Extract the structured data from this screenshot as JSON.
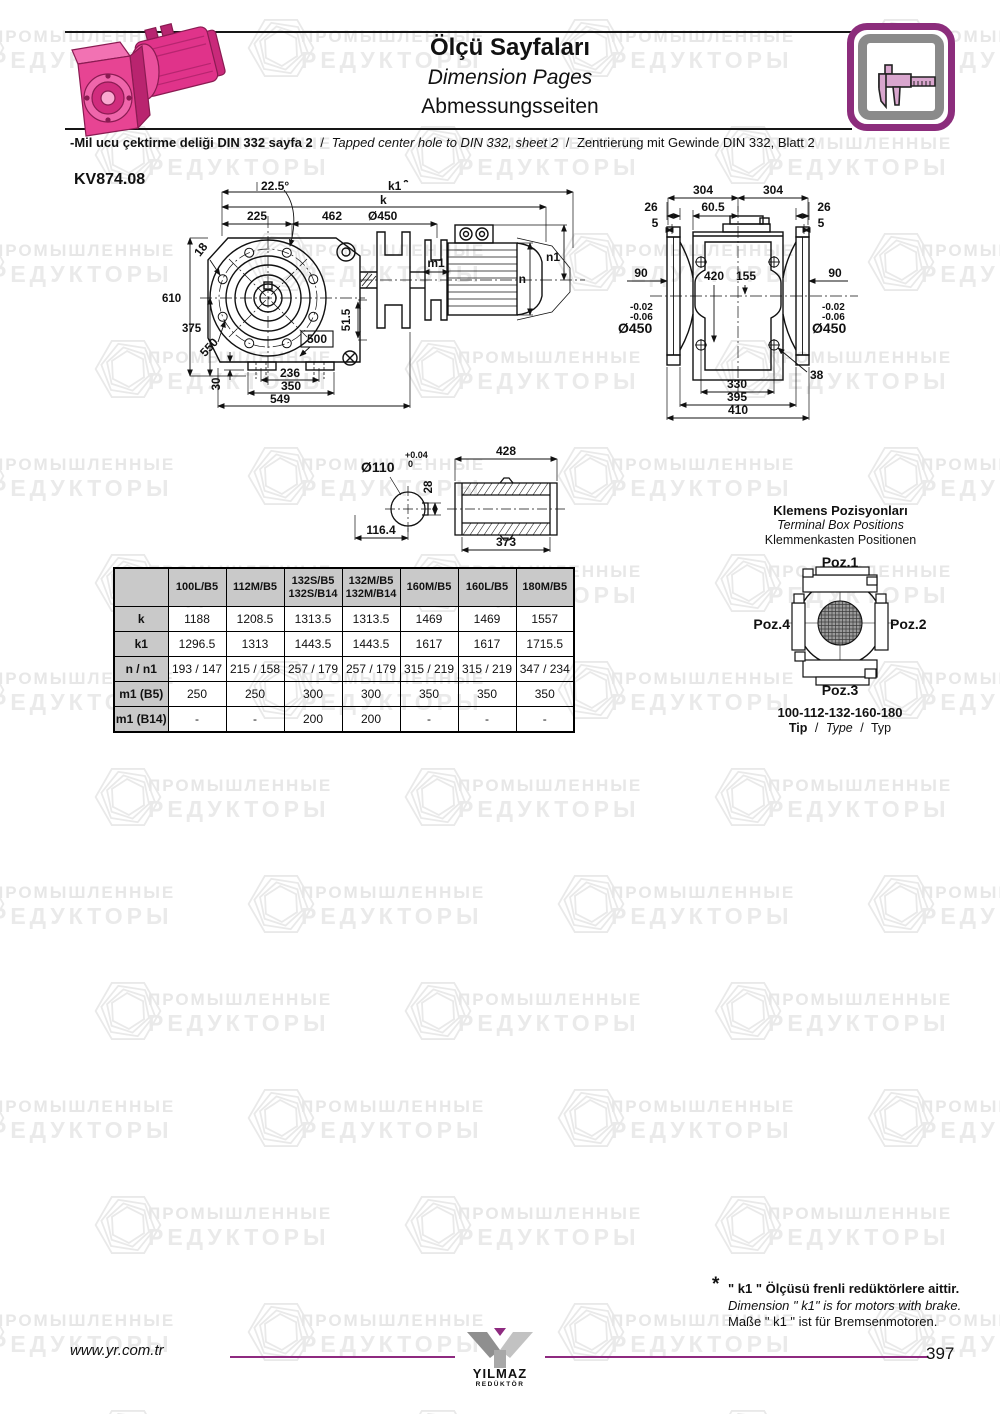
{
  "watermark": {
    "line1": "ПРОМЫШЛЕННЫЕ",
    "line2": "РЕДУКТОРЫ"
  },
  "header": {
    "title_tr": "Ölçü Sayfaları",
    "title_en": "Dimension Pages",
    "title_de": "Abmessungsseiten",
    "note_tr": "-Mil ucu çektirme deliği DIN 332 sayfa 2",
    "sep": "/",
    "note_en": "Tapped center hole to DIN 332, sheet 2",
    "note_de": "Zentrierung mit Gewinde DIN 332, Blatt 2"
  },
  "model": "KV874.08",
  "front_view": {
    "angle": "22.5°",
    "k1": "k1",
    "star": "*",
    "k": "k",
    "d225": "225",
    "d462": "462",
    "dia450": "Ø450",
    "d610": "610",
    "d375": "375",
    "d18": "18",
    "d550": "550",
    "d500": "500",
    "d51_5": "51.5",
    "m1": "m1",
    "n": "n",
    "n1": "n1",
    "d30": "30",
    "d236": "236",
    "d350": "350",
    "d549": "549"
  },
  "side_view": {
    "d304a": "304",
    "d304b": "304",
    "d26a": "26",
    "d60_5": "60.5",
    "d26b": "26",
    "d5a": "5",
    "d5b": "5",
    "d90a": "90",
    "d420": "420",
    "d155": "155",
    "d90b": "90",
    "tol_a1": "-0.02",
    "tol_a2": "-0.06",
    "dia_a": "Ø450",
    "tol_b1": "-0.02",
    "tol_b2": "-0.06",
    "dia_b": "Ø450",
    "d38": "38",
    "d330": "330",
    "d395": "395",
    "d410": "410"
  },
  "shaft": {
    "dia": "Ø110",
    "tol_up": "+0.04",
    "tol_dn": "0",
    "d28": "28",
    "d116": "116.4",
    "d428": "428",
    "d373": "373"
  },
  "terminal": {
    "title_tr": "Klemens Pozisyonları",
    "title_en": "Terminal Box Positions",
    "title_de": "Klemmenkasten Positionen",
    "poz1": "Poz.1",
    "poz2": "Poz.2",
    "poz3": "Poz.3",
    "poz4": "Poz.4",
    "sizes": "100-112-132-160-180",
    "tip_tr": "Tip",
    "sep": "/",
    "tip_en": "Type",
    "tip_de": "Typ"
  },
  "table": {
    "corner": "",
    "headers": [
      "100L/B5",
      "112M/B5",
      "132S/B5\n132S/B14",
      "132M/B5\n132M/B14",
      "160M/B5",
      "160L/B5",
      "180M/B5"
    ],
    "rows": [
      {
        "label": "k",
        "values": [
          "1188",
          "1208.5",
          "1313.5",
          "1313.5",
          "1469",
          "1469",
          "1557"
        ]
      },
      {
        "label": "k1",
        "values": [
          "1296.5",
          "1313",
          "1443.5",
          "1443.5",
          "1617",
          "1617",
          "1715.5"
        ]
      },
      {
        "label": "n / n1",
        "values": [
          "193 / 147",
          "215 / 158",
          "257 / 179",
          "257 / 179",
          "315 / 219",
          "315 / 219",
          "347 / 234"
        ]
      },
      {
        "label": "m1 (B5)",
        "values": [
          "250",
          "250",
          "300",
          "300",
          "350",
          "350",
          "350"
        ]
      },
      {
        "label": "m1 (B14)",
        "values": [
          "-",
          "-",
          "200",
          "200",
          "-",
          "-",
          "-"
        ]
      }
    ]
  },
  "footnote": {
    "star": "*",
    "tr": "\" k1 \" Ölçüsü frenli redüktörlere aittir.",
    "en": "Dimension \" k1\" is for motors with brake.",
    "de": "Maße \" k1 \" ist für Bremsenmotoren."
  },
  "footer": {
    "website": "www.yr.com.tr",
    "logo_name": "YILMAZ",
    "logo_sub": "REDÜKTÖR",
    "page": "397"
  },
  "colors": {
    "accent_magenta": "#8e2a80",
    "table_header_bg": "#c9c9c9",
    "motor_pink": "#e23a8e",
    "drawing_ink": "#111111",
    "watermark_gray": "#e8e8e8"
  }
}
